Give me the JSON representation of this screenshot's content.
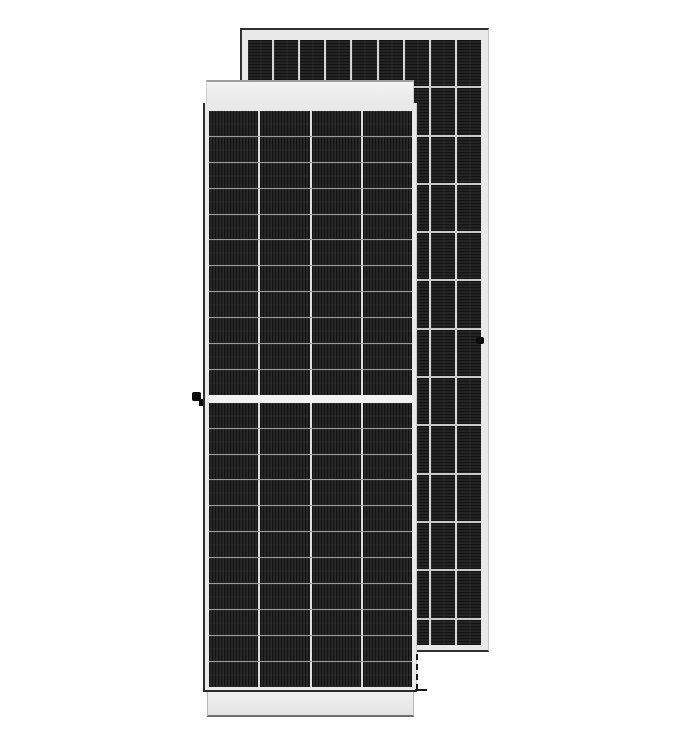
{
  "scene": {
    "description": "Product render of two framed monocrystalline solar PV modules on a plain white background; no text is visible",
    "background_color": "#ffffff"
  },
  "rear_panel": {
    "frame": {
      "x": 240,
      "y": 28,
      "width": 249,
      "height": 624,
      "fill": "#e9e9e9"
    },
    "edge_dark": "#303030",
    "edge_light": "#c8c8c8",
    "cell_grid": {
      "x": 248,
      "y": 40,
      "width": 233,
      "height": 605,
      "columns": 9,
      "rows": 13,
      "row_height": 46.3,
      "row_gap": 2,
      "col_gap": 2,
      "col_divider_color": "#d6d6d6",
      "row_divider_color": "#c9c9c9",
      "cell_color": "#1c1c1c",
      "stripe_light": "#2a2a2a",
      "stripe_dark": "#131313",
      "stripe_direction": "horizontal"
    },
    "grounding_knob": {
      "x": 476,
      "y": 337,
      "width": 8,
      "height": 7,
      "color": "#0b0b0b"
    }
  },
  "front_panel": {
    "top_cap": {
      "x": 206,
      "y": 80,
      "width": 208,
      "height": 28,
      "fill_top": "#f3f3f3",
      "fill_bottom": "#e7e7e7"
    },
    "body": {
      "x": 203,
      "y": 103,
      "width": 214,
      "height": 589,
      "fill": "#e9e9e9"
    },
    "cell_grid": {
      "x": 209,
      "y": 111,
      "width": 203,
      "height": 576,
      "columns": 4,
      "rows_per_half": 11,
      "row_height": 24.9,
      "row_gap": 1,
      "col_gap": 2,
      "middle_gap": 8,
      "middle_gap_color": "#f2f2f2",
      "col_divider_color": "#dedede",
      "row_divider_color": "#9b9b9b",
      "cell_color": "#1d1d1d",
      "stripe_light": "#2d2d2d",
      "stripe_dark": "#121212",
      "stripe_direction": "vertical"
    },
    "bottom_band": {
      "x": 207,
      "y": 692,
      "width": 207,
      "height": 25,
      "fill_top": "#f0f0f0",
      "fill_bottom": "#e4e4e4"
    },
    "grounding_knob": {
      "x": 192,
      "y": 392,
      "width": 9,
      "height": 9,
      "color": "#0b0b0b"
    },
    "knob_tab": {
      "x": 199,
      "y": 399,
      "width": 4,
      "height": 7,
      "color": "#0b0b0b"
    },
    "edge_dashes": {
      "x": 415,
      "y": 654,
      "height": 36,
      "corner_y": 688,
      "corner_width": 12,
      "color": "#1a1a1a"
    }
  }
}
